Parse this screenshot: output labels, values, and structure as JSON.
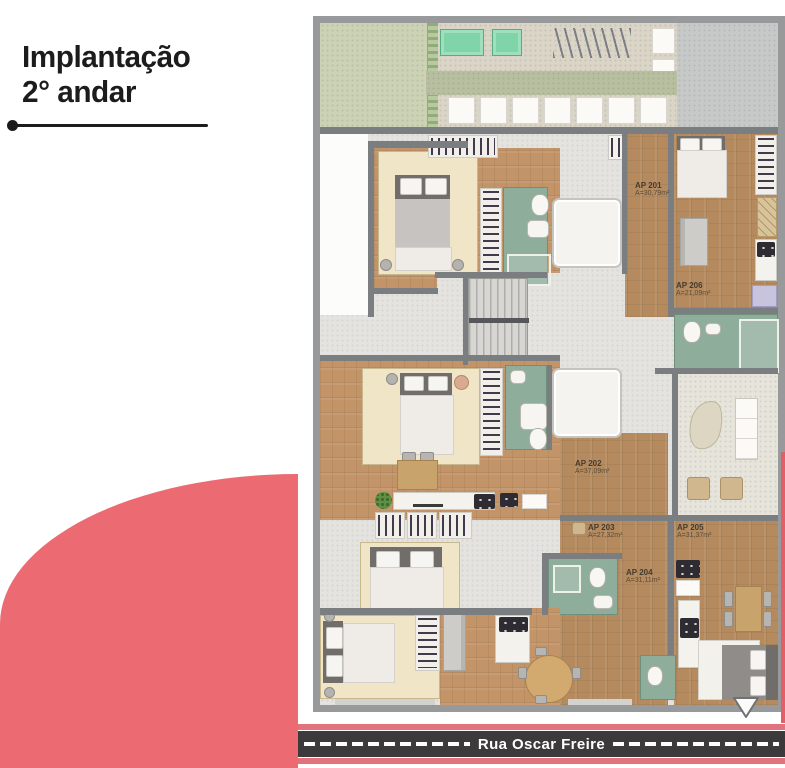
{
  "header": {
    "title_line1": "Implantação",
    "title_line2": "2° andar"
  },
  "plan": {
    "apartments": [
      {
        "id": "AP 201",
        "area": "A=30,79m²"
      },
      {
        "id": "AP 206",
        "area": "A=21,09m²"
      },
      {
        "id": "AP 202",
        "area": "A=37,09m²"
      },
      {
        "id": "AP 203",
        "area": "A=27,32m²"
      },
      {
        "id": "AP 205",
        "area": "A=31,37m²"
      },
      {
        "id": "AP 204",
        "area": "A=31,11m²"
      }
    ]
  },
  "street": {
    "name": "Rua Oscar Freire"
  },
  "icons": {
    "entrance_marker": "chevron-down"
  },
  "colors": {
    "pink_accent": "#ec6b72",
    "street_pink": "#e2737c",
    "road": "#3c3a3a",
    "wall": "#97999a",
    "wall_inner": "#7b7e80",
    "wood": "#b48a5e",
    "wood_light": "#c29468",
    "rug": "#f0e5c6",
    "bath": "#8ead9a",
    "grass": "#ccd2b4",
    "paved": "#dad5c6",
    "teal": "#7fd4a8",
    "gray_block": "#c6c9c8",
    "corridor": "#e4e3df",
    "title": "#1c1c1c"
  }
}
